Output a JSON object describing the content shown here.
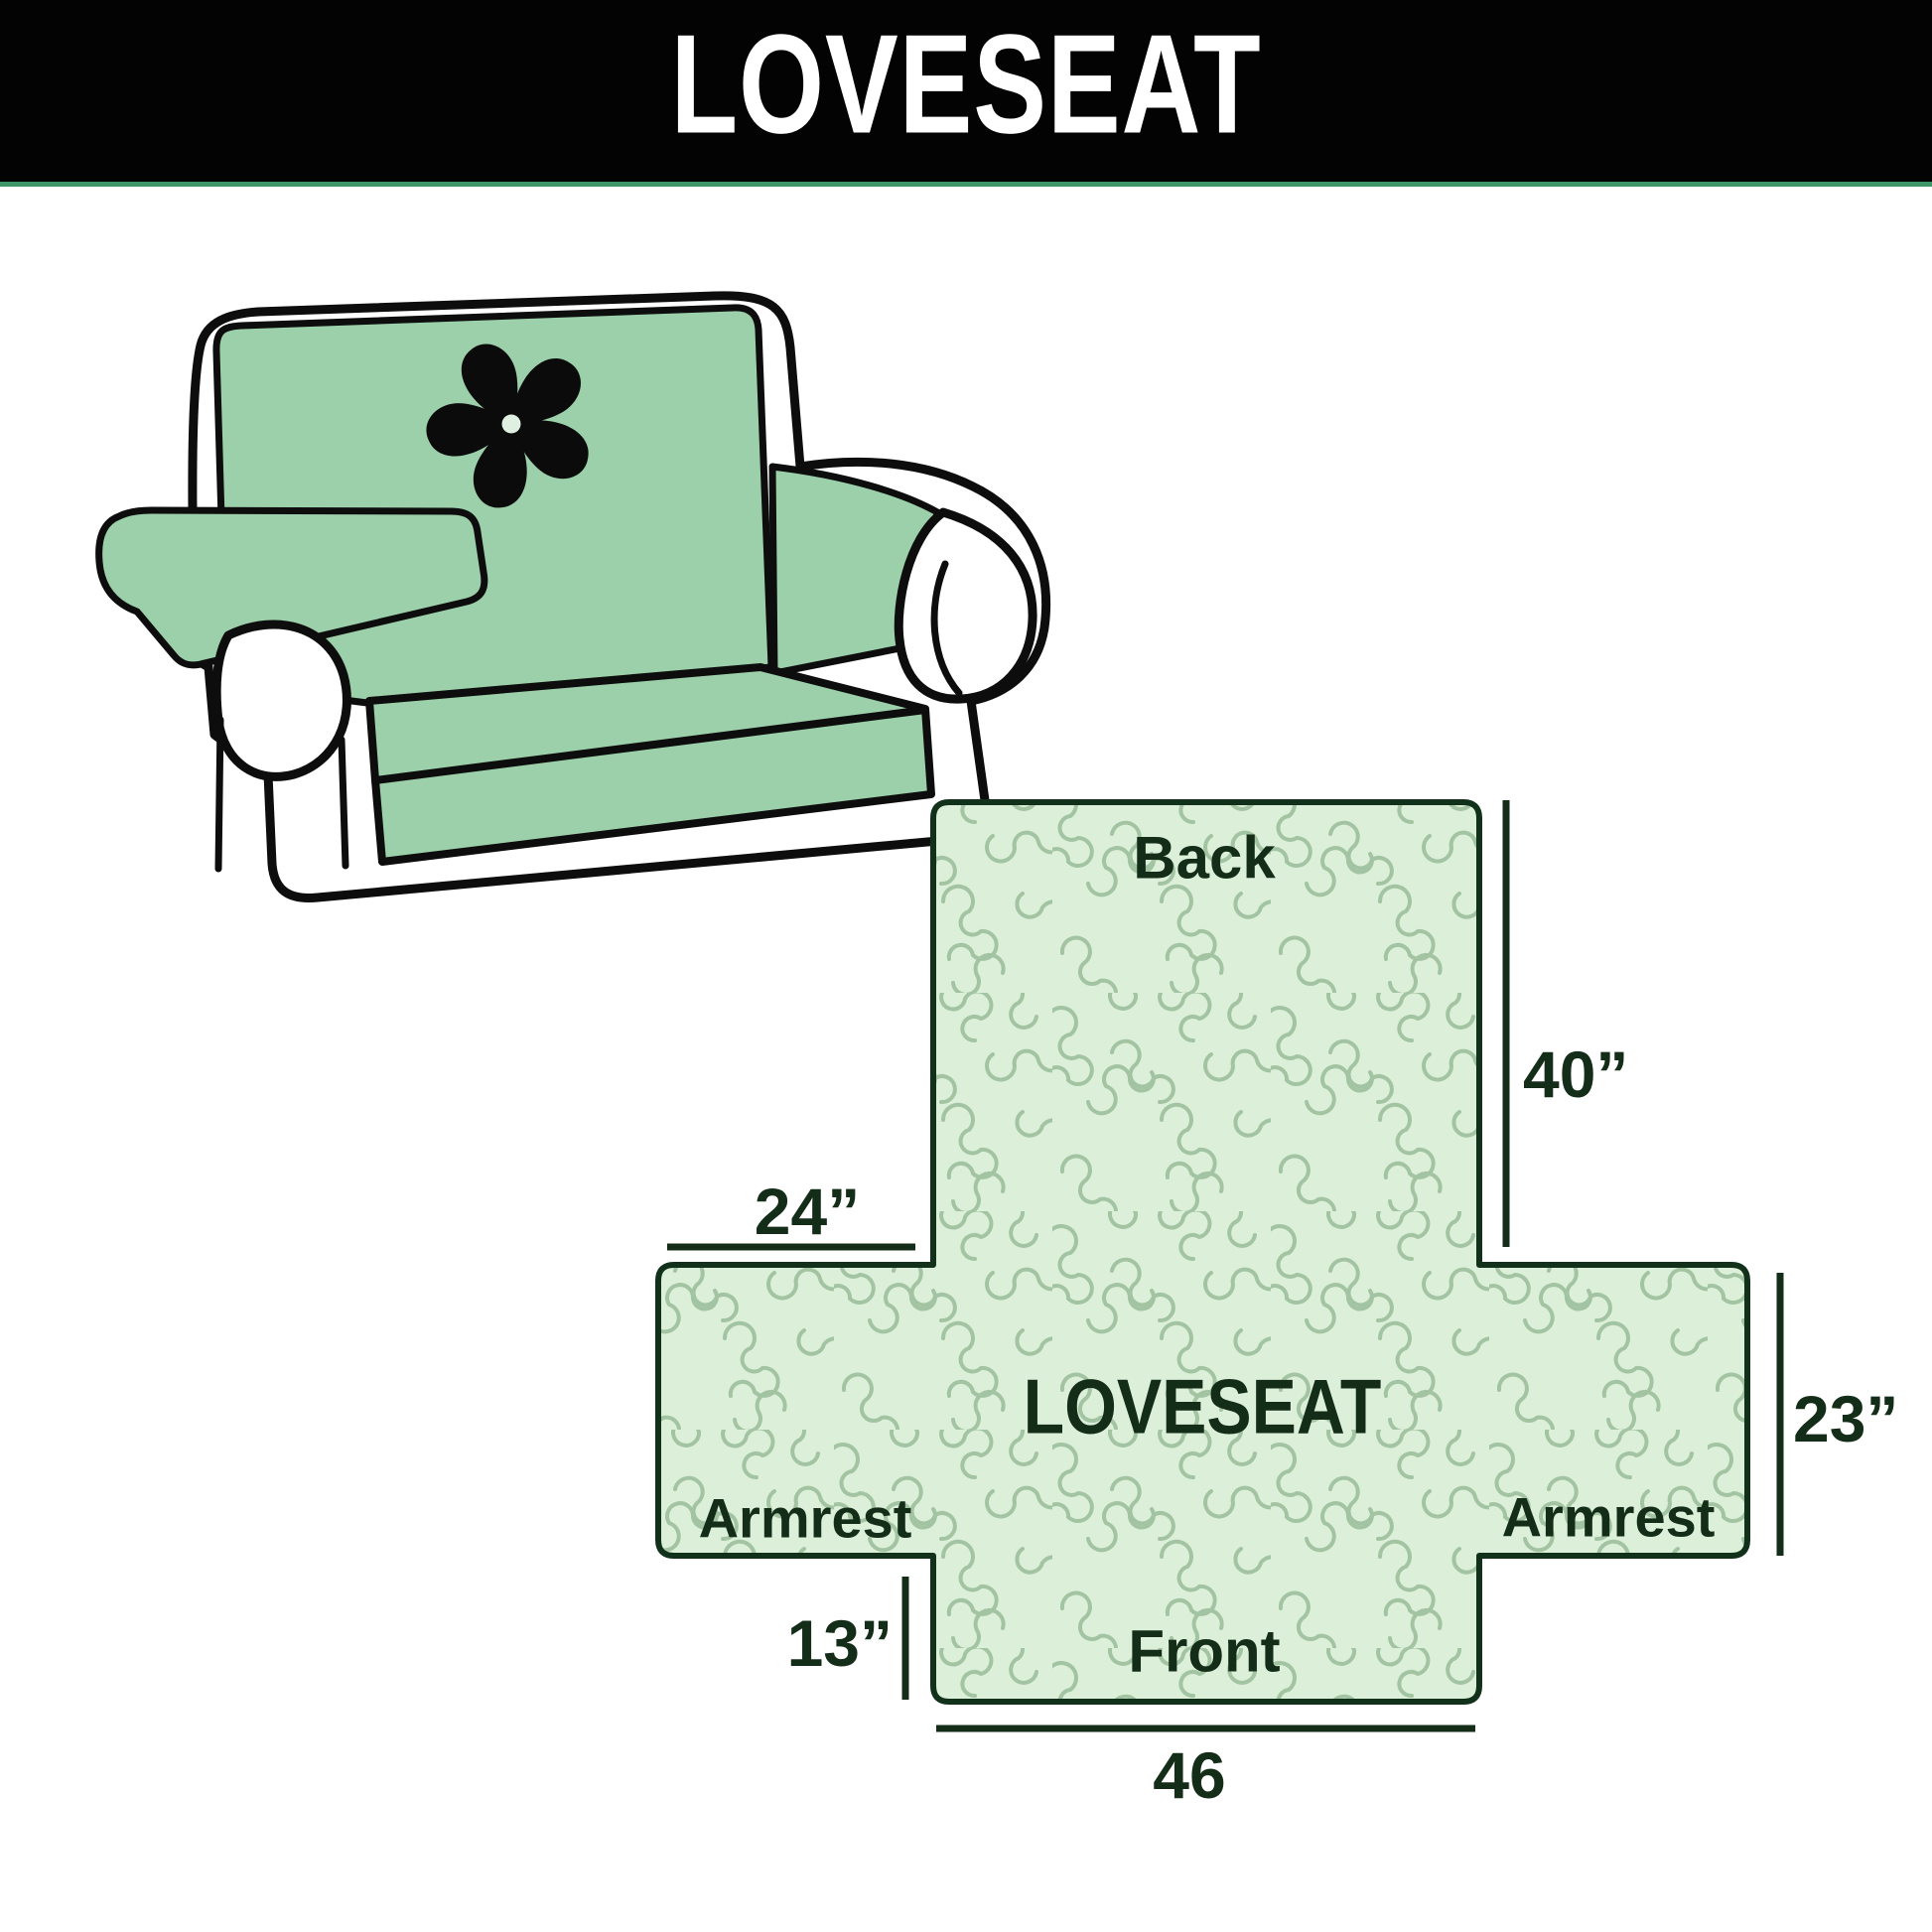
{
  "header": {
    "title": "LOVESEAT",
    "bg_color": "#030303",
    "text_color": "#ffffff",
    "underline_color": "#3e9766"
  },
  "illustration": {
    "description": "loveseat sofa with quilted green furniture cover",
    "cover_color": "#9cd0aa",
    "outline_color": "#0d0d0d",
    "logo": "pinwheel-icon"
  },
  "diagram": {
    "center_label": "LOVESEAT",
    "back_label": "Back",
    "front_label": "Front",
    "armrest_left_label": "Armrest",
    "armrest_right_label": "Armrest",
    "dim_back_height": "40”",
    "dim_armrest_length": "24”",
    "dim_armrest_height": "23”",
    "dim_front_drop": "13”",
    "dim_bottom_width": "46",
    "pattern_fill": "#dcefd8",
    "pattern_stroke": "#a3c4a2",
    "outline_color": "#12311a",
    "text_color": "#142d18"
  }
}
